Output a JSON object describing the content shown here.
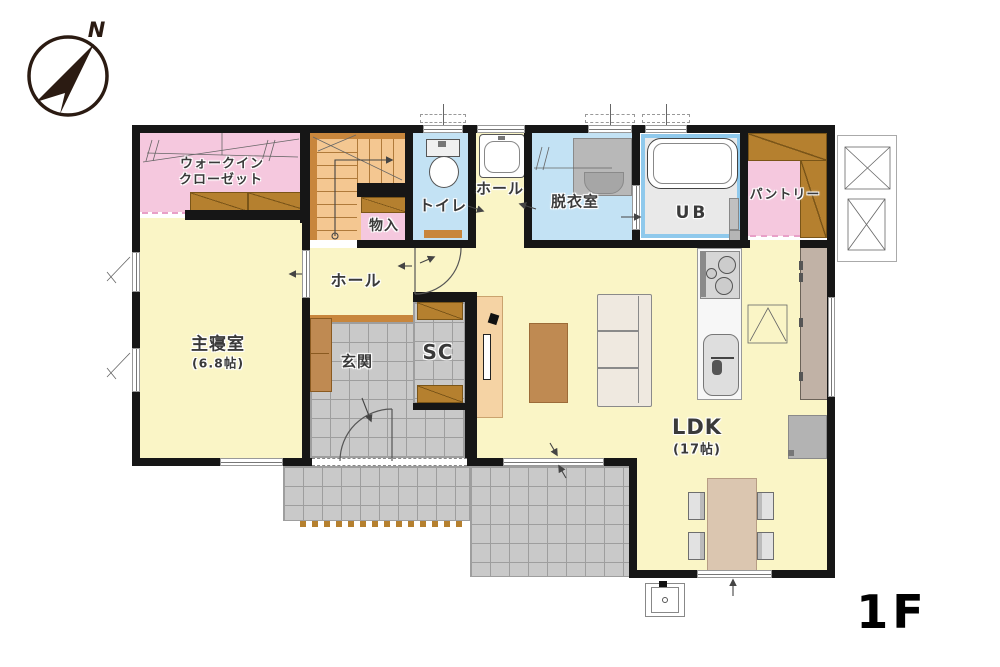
{
  "floor_label": "1F",
  "compass": {
    "north_label": "N"
  },
  "rooms": {
    "walk_in_closet": {
      "line1": "ウォークイン",
      "line2": "クローゼット"
    },
    "storage": {
      "label": "物入"
    },
    "toilet": {
      "label": "トイレ"
    },
    "upper_hall": {
      "label": "ホール"
    },
    "laundry_room": {
      "label": "脱衣室"
    },
    "unit_bath": {
      "label": "UB"
    },
    "pantry": {
      "label": "パントリー"
    },
    "master_bedroom": {
      "label": "主寝室",
      "area": "(6.8帖)"
    },
    "hall": {
      "label": "ホール"
    },
    "entrance": {
      "label": "玄関"
    },
    "shoe_closet": {
      "label": "SC"
    },
    "ldk": {
      "label": "LDK",
      "area": "(17帖)"
    }
  },
  "colors": {
    "wall": "#161616",
    "floor_cream": "#faf5c6",
    "floor_pink": "#f5c8de",
    "floor_blue": "#c3e2f4",
    "tile_gray": "#c9c9c9",
    "tile_line": "#9e9e9e",
    "stairs_orange": "#f4c791",
    "wood_brown": "#c8863c",
    "shelf_brown": "#b5802f",
    "ub_frame": "#8fc9ec",
    "ub_floor": "#e9e9e9",
    "sofa_beige": "#efe9e0",
    "table_brown": "#bf8a52",
    "dining_tan": "#dbc6b0",
    "tv_board_tan": "#f5d3a4",
    "cabinet_taupe": "#c1b2a6",
    "appliance_gray": "#b3b3b3",
    "label_color": "#3a3a3a"
  }
}
